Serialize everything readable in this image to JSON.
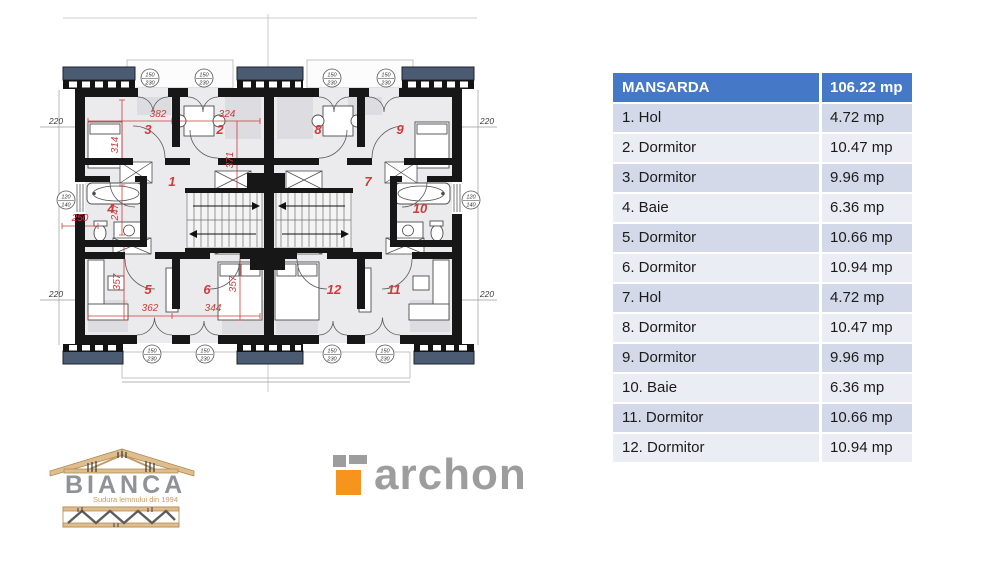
{
  "table": {
    "header": {
      "label": "MANSARDA",
      "value": "106.22 mp"
    },
    "rows": [
      {
        "label": "1. Hol",
        "value": "4.72 mp"
      },
      {
        "label": "2. Dormitor",
        "value": "10.47 mp"
      },
      {
        "label": "3. Dormitor",
        "value": "9.96 mp"
      },
      {
        "label": "4. Baie",
        "value": "6.36 mp"
      },
      {
        "label": "5. Dormitor",
        "value": "10.66 mp"
      },
      {
        "label": "6. Dormitor",
        "value": "10.94 mp"
      },
      {
        "label": "7. Hol",
        "value": "4.72 mp"
      },
      {
        "label": "8. Dormitor",
        "value": "10.47 mp"
      },
      {
        "label": "9. Dormitor",
        "value": "9.96 mp"
      },
      {
        "label": "10. Baie",
        "value": "6.36 mp"
      },
      {
        "label": "11. Dormitor",
        "value": "10.66 mp"
      },
      {
        "label": "12. Dormitor",
        "value": "10.94 mp"
      }
    ]
  },
  "floor_plan": {
    "title": "Mansarda floor plan - mirrored duplex",
    "room_numbers": [
      "1",
      "2",
      "3",
      "4",
      "5",
      "6",
      "7",
      "8",
      "9",
      "10",
      "11",
      "12"
    ],
    "red_dims": {
      "w382": "382",
      "w324": "324",
      "h314": "314",
      "h371": "371",
      "h247": "247",
      "w250": "250",
      "h357a": "357",
      "w362": "362",
      "w344": "344",
      "h357b": "357"
    },
    "outer_dim": "220",
    "window_front": {
      "w": "150",
      "h": "230"
    },
    "window_side": {
      "w": "120",
      "h": "140"
    }
  },
  "logos": {
    "bianca": {
      "name": "BIANCA",
      "tagline": "Sudura lemnului din 1994"
    },
    "archon": {
      "name": "archon"
    }
  },
  "colors": {
    "table_header_bg": "#4678c8",
    "table_row_dark": "#d3d9e8",
    "table_row_light": "#eaedf4",
    "plan_red": "#cf3b3b",
    "roof_navy": "#4a5b72",
    "archon_orange": "#f7941d",
    "logo_gray": "#9d9d9d"
  }
}
